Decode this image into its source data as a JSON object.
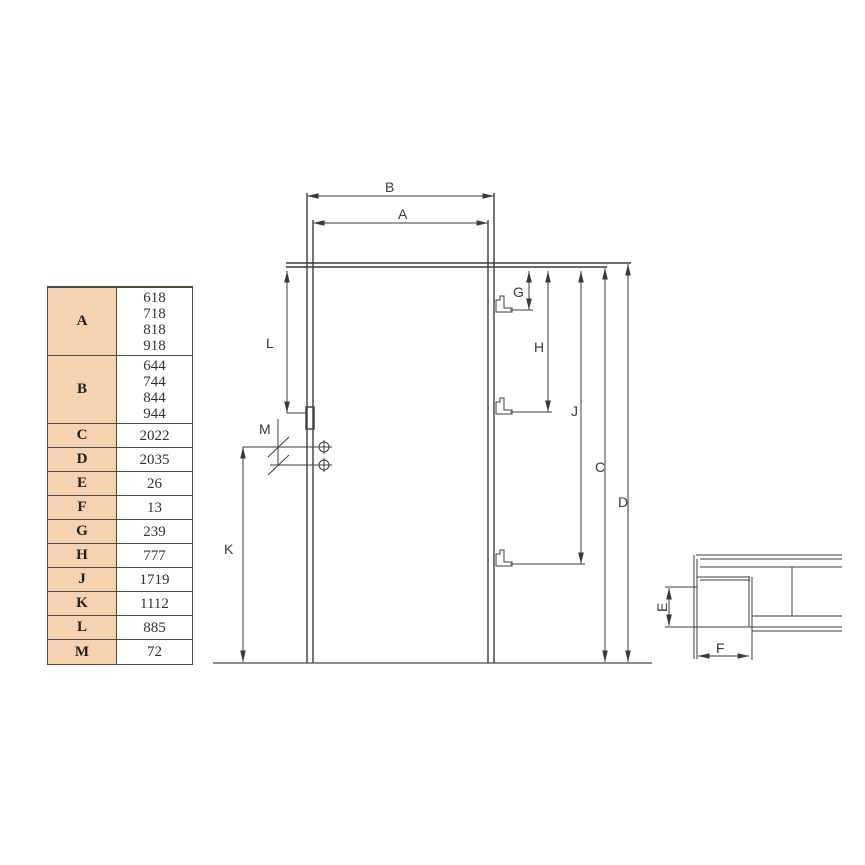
{
  "table": {
    "rows": [
      {
        "label": "A",
        "values": [
          "618",
          "718",
          "818",
          "918"
        ]
      },
      {
        "label": "B",
        "values": [
          "644",
          "744",
          "844",
          "944"
        ]
      },
      {
        "label": "C",
        "values": [
          "2022"
        ]
      },
      {
        "label": "D",
        "values": [
          "2035"
        ]
      },
      {
        "label": "E",
        "values": [
          "26"
        ]
      },
      {
        "label": "F",
        "values": [
          "13"
        ]
      },
      {
        "label": "G",
        "values": [
          "239"
        ]
      },
      {
        "label": "H",
        "values": [
          "777"
        ]
      },
      {
        "label": "J",
        "values": [
          "1719"
        ]
      },
      {
        "label": "K",
        "values": [
          "1112"
        ]
      },
      {
        "label": "L",
        "values": [
          "885"
        ]
      },
      {
        "label": "M",
        "values": [
          "72"
        ]
      }
    ],
    "colors": {
      "label_cell_bg": "#f6d2b0",
      "value_cell_bg": "#ffffff",
      "border": "#4d4d4d"
    }
  },
  "diagram": {
    "dim_labels": {
      "A": "A",
      "B": "B",
      "C": "C",
      "D": "D",
      "G": "G",
      "H": "H",
      "J": "J",
      "K": "K",
      "L": "L",
      "M": "M"
    },
    "line_color": "#3d3d3d",
    "floor_color": "#8c8c8c"
  },
  "detail": {
    "dim_labels": {
      "E": "E",
      "F": "F"
    }
  }
}
